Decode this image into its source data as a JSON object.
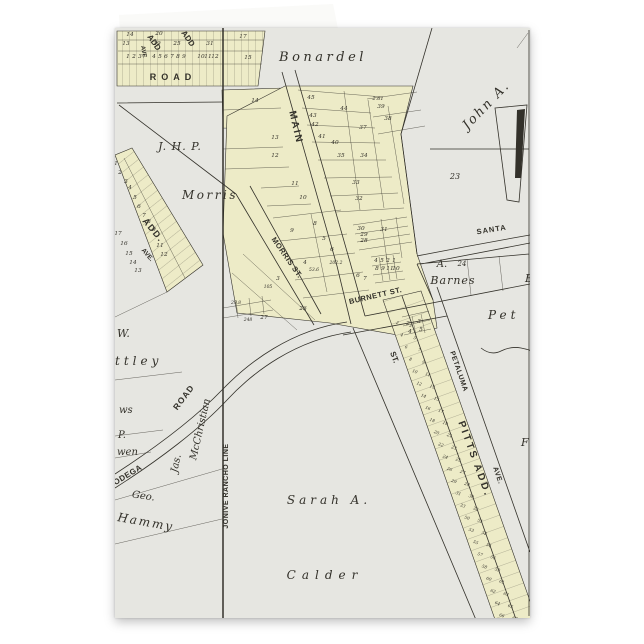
{
  "scene": {
    "background": "#ffffff"
  },
  "card": {
    "colors": {
      "paper": "#e6e6e1",
      "plat": "#edebc7",
      "ink": "#33312a",
      "flap": "#fafaf8"
    }
  },
  "map": {
    "labels": [
      {
        "t": "Bonardel",
        "x": 208,
        "y": 33,
        "s": 13,
        "f": "serif",
        "i": 1,
        "sp": 3.5
      },
      {
        "t": "John A.",
        "x": 374,
        "y": 80,
        "s": 13,
        "f": "serif",
        "i": 1,
        "sp": 2,
        "r": -46
      },
      {
        "t": "23",
        "x": 340,
        "y": 151,
        "s": 8,
        "f": "serif",
        "i": 1
      },
      {
        "t": "J. H. P.",
        "x": 65,
        "y": 122,
        "s": 11,
        "f": "serif",
        "i": 1,
        "sp": 1
      },
      {
        "t": "Morris",
        "x": 95,
        "y": 171,
        "s": 12,
        "f": "serif",
        "i": 1,
        "sp": 2.5
      },
      {
        "t": "A.",
        "x": 327,
        "y": 239,
        "s": 10,
        "f": "serif",
        "i": 1
      },
      {
        "t": "24",
        "x": 347,
        "y": 238,
        "s": 7,
        "f": "serif",
        "i": 1
      },
      {
        "t": "Barnes",
        "x": 338,
        "y": 256,
        "s": 11,
        "f": "serif",
        "i": 1,
        "sp": 1
      },
      {
        "t": "B",
        "x": 410,
        "y": 254,
        "s": 11,
        "f": "serif",
        "i": 1,
        "a": "s"
      },
      {
        "t": "Pet",
        "x": 373,
        "y": 291,
        "s": 12,
        "f": "serif",
        "i": 1,
        "sp": 4,
        "a": "s"
      },
      {
        "t": "Sarah A.",
        "x": 214,
        "y": 476,
        "s": 12,
        "f": "serif",
        "i": 1,
        "sp": 4
      },
      {
        "t": "Calder",
        "x": 210,
        "y": 551,
        "s": 12,
        "f": "serif",
        "i": 1,
        "sp": 6
      },
      {
        "t": "W.",
        "x": 2,
        "y": 309,
        "s": 11,
        "f": "serif",
        "i": 1,
        "a": "s"
      },
      {
        "t": "ttley",
        "x": 0,
        "y": 337,
        "s": 12,
        "f": "serif",
        "i": 1,
        "sp": 4,
        "a": "s"
      },
      {
        "t": "ws",
        "x": 4,
        "y": 385,
        "s": 10,
        "f": "serif",
        "i": 1,
        "a": "s"
      },
      {
        "t": "P.",
        "x": 3,
        "y": 410,
        "s": 10,
        "f": "serif",
        "i": 1,
        "a": "s"
      },
      {
        "t": "wen",
        "x": 2,
        "y": 427,
        "s": 10,
        "f": "serif",
        "i": 1,
        "a": "s"
      },
      {
        "t": "Geo.",
        "x": 28,
        "y": 471,
        "s": 10,
        "f": "serif",
        "i": 1,
        "r": 8
      },
      {
        "t": "Hammy",
        "x": 2,
        "y": 493,
        "s": 12,
        "f": "serif",
        "i": 1,
        "r": 10,
        "sp": 2,
        "a": "s"
      },
      {
        "t": "Jas.",
        "x": 64,
        "y": 436,
        "s": 10,
        "f": "serif",
        "i": 1,
        "r": -78
      },
      {
        "t": "McChristian",
        "x": 88,
        "y": 402,
        "s": 10,
        "f": "serif",
        "i": 1,
        "r": -77
      },
      {
        "t": "F",
        "x": 406,
        "y": 418,
        "s": 11,
        "f": "serif",
        "i": 1,
        "a": "s"
      },
      {
        "t": "MAIN",
        "x": 178,
        "y": 100,
        "s": 10,
        "f": "sans",
        "b": 1,
        "sp": 2,
        "r": 77
      },
      {
        "t": "MORRIS ST.",
        "x": 170,
        "y": 231,
        "s": 7.5,
        "f": "sans",
        "b": 1,
        "sp": 0.5,
        "r": 55
      },
      {
        "t": "BURNETT ST.",
        "x": 261,
        "y": 270,
        "s": 7.5,
        "f": "sans",
        "b": 1,
        "sp": 0.5,
        "r": -13
      },
      {
        "t": "SANTA",
        "x": 377,
        "y": 204,
        "s": 7.5,
        "f": "sans",
        "b": 1,
        "sp": 1,
        "r": -9
      },
      {
        "t": "ST.",
        "x": 277,
        "y": 330,
        "s": 8,
        "f": "sans",
        "b": 1,
        "r": 70
      },
      {
        "t": "PETALUMA",
        "x": 342,
        "y": 344,
        "s": 7,
        "f": "sans",
        "b": 1,
        "sp": 0.5,
        "r": 71
      },
      {
        "t": "AVE.",
        "x": 381,
        "y": 448,
        "s": 7,
        "f": "sans",
        "b": 1,
        "sp": 0.5,
        "r": 71
      },
      {
        "t": "PITTS ADD.",
        "x": 357,
        "y": 432,
        "s": 10,
        "f": "sans",
        "b": 1,
        "sp": 2.5,
        "r": 70
      },
      {
        "t": "ROAD",
        "x": 58,
        "y": 52,
        "s": 9,
        "f": "sans",
        "b": 1,
        "sp": 5
      },
      {
        "t": "ROAD",
        "x": 71,
        "y": 371,
        "s": 8.5,
        "f": "sans",
        "b": 1,
        "sp": 1,
        "r": -53
      },
      {
        "t": "ODEGA",
        "x": 14,
        "y": 449,
        "s": 8,
        "f": "sans",
        "b": 1,
        "sp": 0.5,
        "r": -31
      },
      {
        "t": "JONIVE RANCHO LINE",
        "x": 113,
        "y": 458,
        "s": 7,
        "f": "sans",
        "b": 1,
        "sp": 0.5,
        "r": -90
      },
      {
        "t": "ADD.",
        "x": 36,
        "y": 204,
        "s": 9,
        "f": "sans",
        "b": 1,
        "sp": 1.5,
        "r": 50
      },
      {
        "t": "AVE.",
        "x": 31,
        "y": 228,
        "s": 6.5,
        "f": "sans",
        "b": 1,
        "r": 50
      },
      {
        "t": "ADD",
        "x": 37,
        "y": 16,
        "s": 8,
        "f": "sans",
        "b": 1,
        "r": 55
      },
      {
        "t": "ADD",
        "x": 71,
        "y": 12,
        "s": 8,
        "f": "sans",
        "b": 1,
        "r": 55
      },
      {
        "t": "AVE",
        "x": 27,
        "y": 24,
        "s": 6,
        "f": "sans",
        "b": 1,
        "r": 80
      },
      {
        "t": "2.61",
        "x": 263,
        "y": 72,
        "s": 5,
        "f": "serif",
        "i": 1
      },
      {
        "t": "53.6",
        "x": 199,
        "y": 243,
        "s": 4.5,
        "f": "serif",
        "i": 1
      },
      {
        "t": "202.2",
        "x": 221,
        "y": 236,
        "s": 4.5,
        "f": "serif",
        "i": 1
      },
      {
        "t": "105",
        "x": 153,
        "y": 260,
        "s": 4.5,
        "f": "serif",
        "i": 1
      },
      {
        "t": "29.8",
        "x": 121,
        "y": 276,
        "s": 4.5,
        "f": "serif",
        "i": 1
      },
      {
        "t": "248",
        "x": 133,
        "y": 293,
        "s": 4.5,
        "f": "serif",
        "i": 1
      }
    ],
    "lot_numbers": [
      {
        "t": "14",
        "x": 15,
        "y": 8
      },
      {
        "t": "13",
        "x": 11,
        "y": 17
      },
      {
        "t": "20",
        "x": 44,
        "y": 7
      },
      {
        "t": "19",
        "x": 42,
        "y": 17
      },
      {
        "t": "25",
        "x": 62,
        "y": 17
      },
      {
        "t": "31",
        "x": 95,
        "y": 17
      },
      {
        "t": "17",
        "x": 128,
        "y": 10
      },
      {
        "t": "15",
        "x": 133,
        "y": 31
      },
      {
        "t": "1",
        "x": 13,
        "y": 30
      },
      {
        "t": "2",
        "x": 19,
        "y": 30
      },
      {
        "t": "3",
        "x": 25,
        "y": 30
      },
      {
        "t": "4",
        "x": 39,
        "y": 30
      },
      {
        "t": "5",
        "x": 45,
        "y": 30
      },
      {
        "t": "6",
        "x": 51,
        "y": 30
      },
      {
        "t": "7",
        "x": 57,
        "y": 30
      },
      {
        "t": "8",
        "x": 63,
        "y": 30
      },
      {
        "t": "9",
        "x": 69,
        "y": 30
      },
      {
        "t": "10",
        "x": 86,
        "y": 30
      },
      {
        "t": "11",
        "x": 93,
        "y": 30
      },
      {
        "t": "12",
        "x": 100,
        "y": 30
      },
      {
        "t": "14",
        "x": 140,
        "y": 74
      },
      {
        "t": "13",
        "x": 160,
        "y": 111
      },
      {
        "t": "12",
        "x": 160,
        "y": 129
      },
      {
        "t": "11",
        "x": 180,
        "y": 157
      },
      {
        "t": "10",
        "x": 188,
        "y": 171
      },
      {
        "t": "45",
        "x": 196,
        "y": 71
      },
      {
        "t": "43",
        "x": 198,
        "y": 89
      },
      {
        "t": "42",
        "x": 200,
        "y": 98
      },
      {
        "t": "41",
        "x": 207,
        "y": 110
      },
      {
        "t": "40",
        "x": 220,
        "y": 116
      },
      {
        "t": "44",
        "x": 229,
        "y": 82
      },
      {
        "t": "37",
        "x": 248,
        "y": 101
      },
      {
        "t": "39",
        "x": 266,
        "y": 80
      },
      {
        "t": "38",
        "x": 273,
        "y": 92
      },
      {
        "t": "35",
        "x": 226,
        "y": 129
      },
      {
        "t": "34",
        "x": 249,
        "y": 129
      },
      {
        "t": "33",
        "x": 241,
        "y": 156
      },
      {
        "t": "32",
        "x": 244,
        "y": 172
      },
      {
        "t": "9",
        "x": 177,
        "y": 204
      },
      {
        "t": "8",
        "x": 200,
        "y": 197
      },
      {
        "t": "5",
        "x": 209,
        "y": 212
      },
      {
        "t": "6",
        "x": 217,
        "y": 223
      },
      {
        "t": "4",
        "x": 190,
        "y": 236
      },
      {
        "t": "3",
        "x": 163,
        "y": 252
      },
      {
        "t": "7",
        "x": 250,
        "y": 252
      },
      {
        "t": "6",
        "x": 243,
        "y": 249
      },
      {
        "t": "30",
        "x": 246,
        "y": 202
      },
      {
        "t": "29",
        "x": 249,
        "y": 208
      },
      {
        "t": "28",
        "x": 249,
        "y": 214
      },
      {
        "t": "31",
        "x": 269,
        "y": 203
      },
      {
        "t": "4",
        "x": 261,
        "y": 234
      },
      {
        "t": "5",
        "x": 267,
        "y": 234
      },
      {
        "t": "2",
        "x": 273,
        "y": 234
      },
      {
        "t": "1",
        "x": 279,
        "y": 234
      },
      {
        "t": "8",
        "x": 262,
        "y": 242
      },
      {
        "t": "9",
        "x": 268,
        "y": 242
      },
      {
        "t": "11",
        "x": 275,
        "y": 242
      },
      {
        "t": "10",
        "x": 281,
        "y": 242
      },
      {
        "t": "26",
        "x": 188,
        "y": 282
      },
      {
        "t": "27",
        "x": 149,
        "y": 291
      },
      {
        "t": "2",
        "x": 293,
        "y": 297
      },
      {
        "t": "3",
        "x": 304,
        "y": 295
      },
      {
        "t": "4",
        "x": 295,
        "y": 305
      },
      {
        "t": "5",
        "x": 306,
        "y": 303
      },
      {
        "t": "1",
        "x": 1,
        "y": 137
      },
      {
        "t": "2",
        "x": 5,
        "y": 146
      },
      {
        "t": "3",
        "x": 11,
        "y": 155
      },
      {
        "t": "4",
        "x": 15,
        "y": 161
      },
      {
        "t": "5",
        "x": 20,
        "y": 171
      },
      {
        "t": "6",
        "x": 24,
        "y": 180
      },
      {
        "t": "7",
        "x": 29,
        "y": 189
      },
      {
        "t": "8",
        "x": 34,
        "y": 195
      },
      {
        "t": "9",
        "x": 39,
        "y": 203
      },
      {
        "t": "17",
        "x": 3,
        "y": 207
      },
      {
        "t": "16",
        "x": 9,
        "y": 217
      },
      {
        "t": "15",
        "x": 14,
        "y": 227
      },
      {
        "t": "14",
        "x": 18,
        "y": 236
      },
      {
        "t": "13",
        "x": 23,
        "y": 244
      },
      {
        "t": "11",
        "x": 45,
        "y": 219
      },
      {
        "t": "12",
        "x": 49,
        "y": 228
      }
    ],
    "strip_lots": {
      "x0": 289,
      "y0": 296,
      "dx": 4.35,
      "dy": 12.2,
      "rot": 20,
      "rows": [
        [
          2,
          3
        ],
        [
          4,
          5
        ],
        [
          6,
          7
        ],
        [
          8,
          9
        ],
        [
          10,
          11
        ],
        [
          12,
          13
        ],
        [
          14,
          15
        ],
        [
          16,
          17
        ],
        [
          18,
          19
        ],
        [
          20,
          21
        ],
        [
          22,
          23
        ],
        [
          24,
          25
        ],
        [
          26,
          27
        ],
        [
          29,
          28
        ],
        [
          31,
          30
        ],
        [
          33,
          32
        ],
        [
          50,
          51
        ],
        [
          53,
          52
        ],
        [
          55,
          54
        ],
        [
          57,
          56
        ],
        [
          58,
          59
        ],
        [
          60,
          61
        ],
        [
          62,
          63
        ],
        [
          64,
          65
        ],
        [
          66,
          67
        ],
        [
          70,
          69
        ]
      ]
    }
  }
}
